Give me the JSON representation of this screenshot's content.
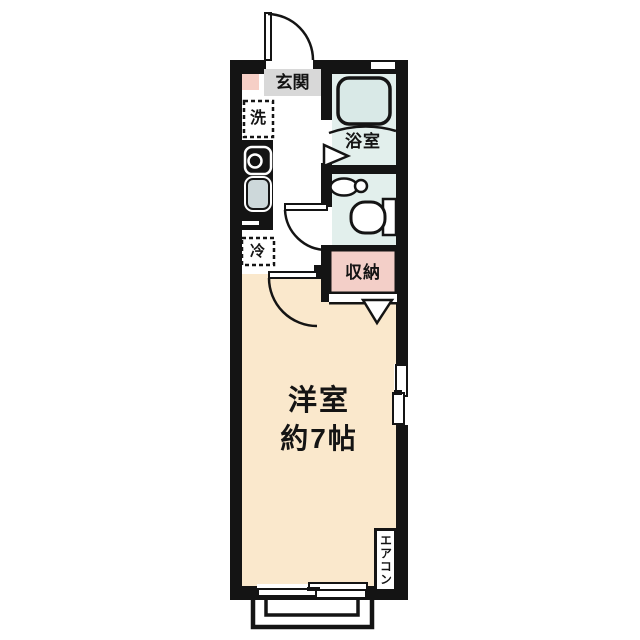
{
  "type": "japanese-apartment-floor-plan",
  "labels": {
    "entrance": "玄関",
    "washing_machine": "洗",
    "bathroom": "浴室",
    "refrigerator": "冷",
    "storage": "収納",
    "main_room_name": "洋室",
    "main_room_size": "約7帖",
    "air_conditioner": "エアコン"
  },
  "colors": {
    "wall": "#141414",
    "main_room_floor": "#fae8cc",
    "wet_area_floor": "#e2efec",
    "hallway_floor": "#ffffff",
    "storage_fill": "#f3cfc8",
    "entrance_step_fill": "#f6cfc6",
    "entrance_label_bg": "#d8d8d8",
    "bathtub_fill": "#d9e9e7",
    "kitchen_sink_fill": "#cdd8da"
  }
}
